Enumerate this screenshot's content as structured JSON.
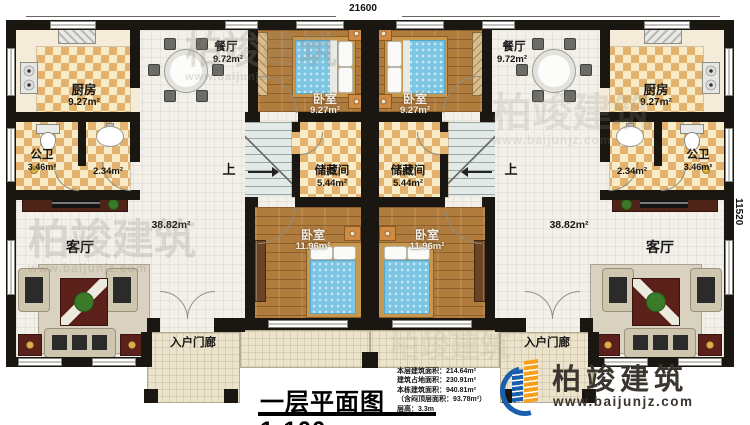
{
  "dimensions": {
    "top_width": "21600",
    "right_height": "11520"
  },
  "rooms": {
    "kitchen": {
      "name": "厨房",
      "area": "9.27m²"
    },
    "dining": {
      "name": "餐厅",
      "area": "9.72m²"
    },
    "bedroom_top": {
      "name": "卧室",
      "area": "9.27m²"
    },
    "bathroom": {
      "name": "公卫",
      "area": "3.46m²"
    },
    "washroom": {
      "area": "2.34m²"
    },
    "storage": {
      "name": "储藏间",
      "area": "5.44m²"
    },
    "living": {
      "name": "客厅",
      "area": "38.82m²"
    },
    "bedroom_main": {
      "name": "卧室",
      "area": "11.96m²"
    },
    "porch": {
      "name": "入户门廊"
    },
    "stair": {
      "up": "上"
    }
  },
  "title": {
    "text": "一层平面图1:100"
  },
  "stats": {
    "items": [
      {
        "label": "本层建筑面积：",
        "value": "214.64m²"
      },
      {
        "label": "建筑占地面积：",
        "value": "230.91m²"
      },
      {
        "label": "本栋建筑面积：",
        "value": "940.81m²"
      },
      {
        "label": "（含闷顶层面积：",
        "value": "93.78m²）"
      },
      {
        "label": "层高：",
        "value": "3.3m"
      }
    ]
  },
  "brand": {
    "name": "柏竣建筑",
    "site": "www.baijunjz.com",
    "blue": "#1a5fae",
    "orange": "#f6a01c",
    "text_color": "#3b3530"
  },
  "watermark": {
    "name": "柏竣建筑",
    "site": "www.baijunjz.com"
  }
}
